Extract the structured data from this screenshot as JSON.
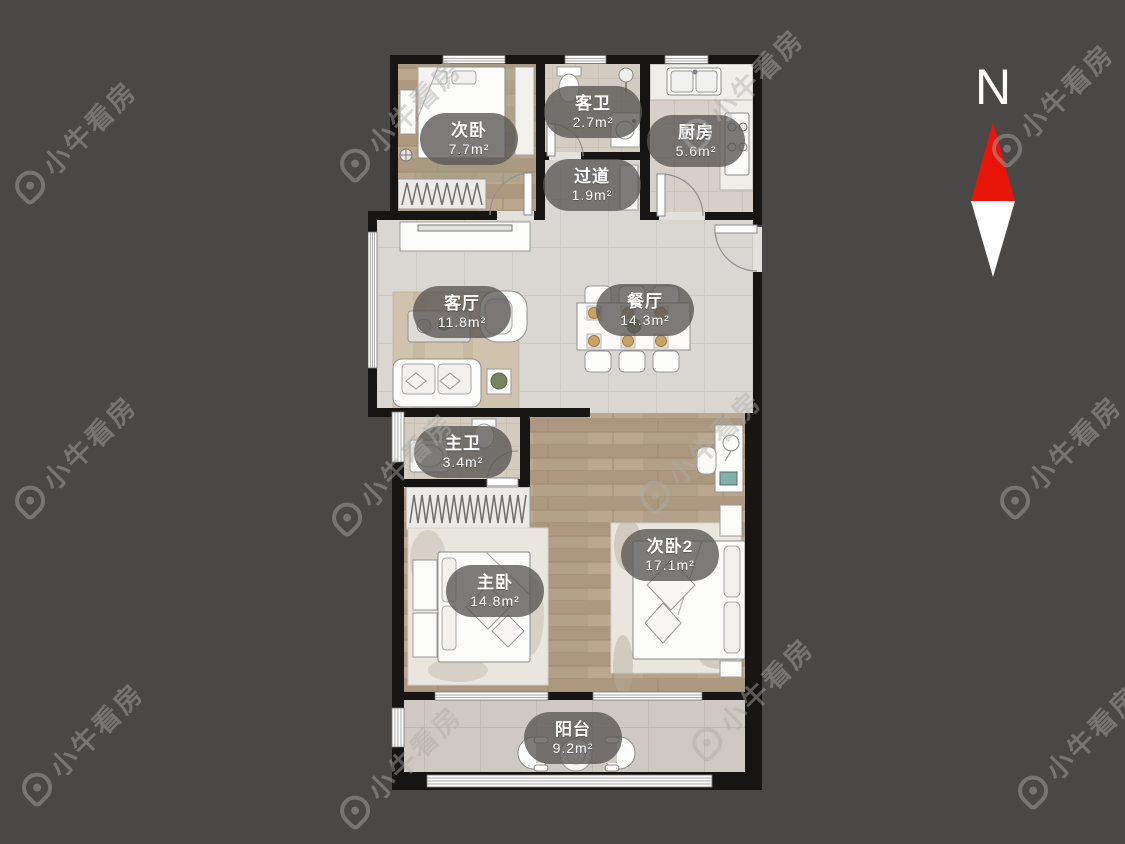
{
  "watermark": {
    "text": "小牛看房"
  },
  "compass": {
    "label": "N",
    "arrow_up_color": "#e81408",
    "arrow_down_color": "#ffffff"
  },
  "floor_plan": {
    "rooms": [
      {
        "id": "bedroom-2",
        "name": "次卧",
        "area": "7.7m²"
      },
      {
        "id": "guest-bathroom",
        "name": "客卫",
        "area": "2.7m²"
      },
      {
        "id": "kitchen",
        "name": "厨房",
        "area": "5.6m²"
      },
      {
        "id": "hallway",
        "name": "过道",
        "area": "1.9m²"
      },
      {
        "id": "living-room",
        "name": "客厅",
        "area": "11.8m²"
      },
      {
        "id": "dining-room",
        "name": "餐厅",
        "area": "14.3m²"
      },
      {
        "id": "master-bathroom",
        "name": "主卫",
        "area": "3.4m²"
      },
      {
        "id": "bedroom-3",
        "name": "次卧2",
        "area": "17.1m²"
      },
      {
        "id": "master-bedroom",
        "name": "主卧",
        "area": "14.8m²"
      },
      {
        "id": "balcony",
        "name": "阳台",
        "area": "9.2m²"
      }
    ],
    "colors": {
      "background": "#4a4747",
      "wall": "#171514",
      "living_tile": "#dad7d2",
      "bath_tile": "#d3ccc1",
      "kitchen_tile": "#d6d0c8",
      "balcony_tile": "#cec9c2",
      "wood_floor": "#b3a088",
      "label_pill": "rgba(88,86,84,0.78)",
      "label_text": "#ffffff"
    }
  }
}
